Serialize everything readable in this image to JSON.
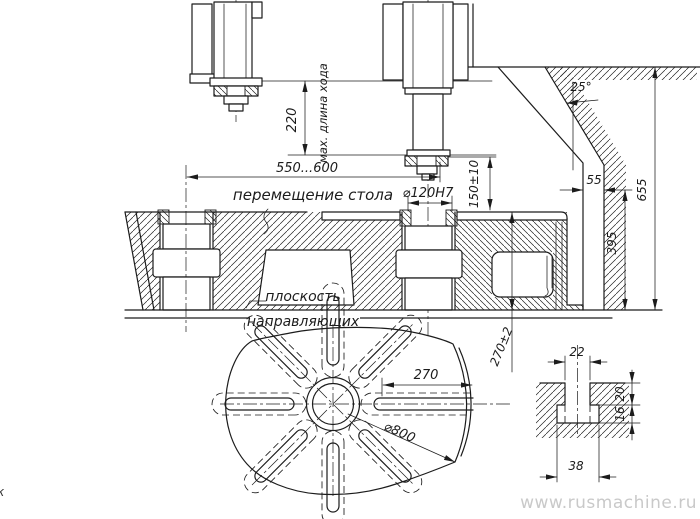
{
  "drawing": {
    "watermark": "www.rusmachine.ru",
    "edge_mark": "к",
    "colors": {
      "ink": "#1c1c1c",
      "watermark": "#c9c9c9",
      "paper": "#ffffff"
    },
    "dims": {
      "stroke": "220",
      "stroke_note": "мах. длина хода",
      "travel": "550...600",
      "travel_note": "перемещение стола",
      "spindle_bore": "⌀120H7",
      "spindle_height": "150±10",
      "angle": "25°",
      "offset": "55",
      "total_height": "655",
      "column_height": "395",
      "plane_1": "плоскость",
      "plane_2": "направляющих",
      "slot_len": "270",
      "table_dia": "⌀800",
      "table_h": "270±2",
      "t_top": "22",
      "t_d1": "20",
      "t_d2": "16",
      "t_bot": "38"
    }
  }
}
